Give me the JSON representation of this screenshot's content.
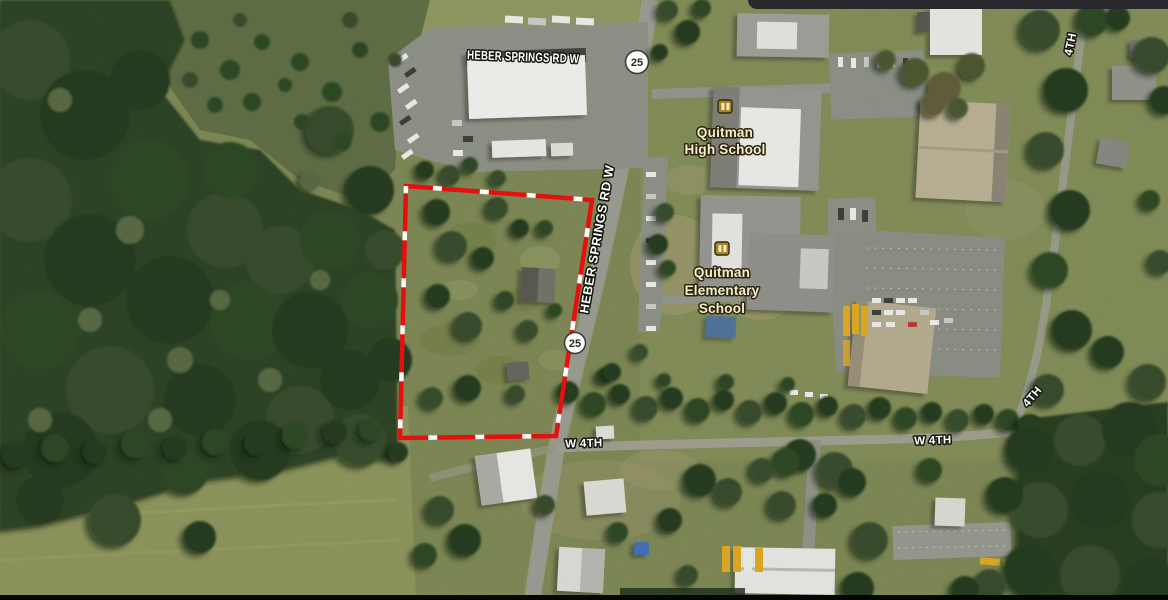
{
  "map": {
    "road_labels": {
      "heber_springs_top": "HEBER SPRINGS RD W",
      "heber_springs_side": "HEBER SPRINGS RD W",
      "w_4th_west": "W 4TH",
      "w_4th_east": "W 4TH",
      "fourth_diagonal": "4TH",
      "fourth_north": "4TH"
    },
    "route_shields": [
      {
        "number": "25"
      },
      {
        "number": "25"
      }
    ],
    "pois": {
      "high_school": {
        "line1": "Quitman",
        "line2": "High School"
      },
      "elementary_school": {
        "line1": "Quitman",
        "line2": "Elementary",
        "line3": "School"
      }
    },
    "overlay": {
      "boundary_color": "#e60b0b",
      "boundary_tick_color": "#ffffff",
      "boundary_style": "solid-red-with-white-ticks"
    },
    "colors": {
      "poi_label": "#f5eecb",
      "road_label": "#ffffff",
      "shield_fill": "#fdfdfa",
      "shield_text": "#2a2a25",
      "shield_border": "#3a3a35"
    }
  }
}
